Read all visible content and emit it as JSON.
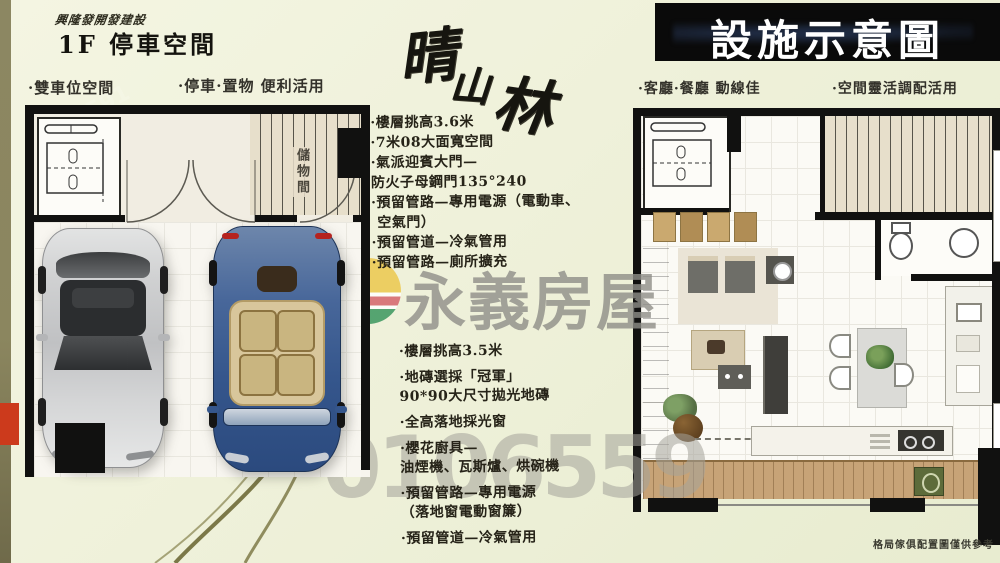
{
  "header_left": {
    "developer": "興隆發開發建設",
    "title": "1F 停車空間",
    "feature1": "·雙車位空間",
    "feature2": "·停車·置物 便利活用"
  },
  "banner": {
    "title": "設施示意圖"
  },
  "header_right": {
    "feature1": "·客廳·餐廳 動線佳",
    "feature2": "·空間靈活調配活用"
  },
  "brand_script": {
    "char1": "晴",
    "char2": "山",
    "char3": "林"
  },
  "garage_plan": {
    "storage_label": "儲物間"
  },
  "notes_garage": {
    "l1": "·樓層挑高3.6米",
    "l2": "·7米08大面寬空間",
    "l3": "·氣派迎賓大門—",
    "l4": "防火子母鋼門135°240",
    "l5": "·預留管路—專用電源（電動車、",
    "l6": "空氣門）",
    "l7": "·預留管道—冷氣管用",
    "l8": "·預留管路—廁所擴充"
  },
  "notes_living": {
    "l1": "·樓層挑高3.5米",
    "l2": "·地磚選採「冠軍」",
    "l3": "90*90大尺寸拋光地磚",
    "l4": "·全高落地採光窗",
    "l5": "·櫻花廚具—",
    "l6": "油煙機、瓦斯爐、烘碗機",
    "l7": "·預留管路—專用電源",
    "l8": "（落地窗電動窗簾）",
    "l9": "·預留管道—冷氣管用"
  },
  "watermark": {
    "brand": "永義房屋",
    "number": "0106559",
    "site": "591"
  },
  "footnote": "格局傢俱配置圖僅供參考",
  "palette": {
    "strip_olive": "#8c8762",
    "accent_red": "#cc3a1c",
    "wall_black": "#111110",
    "stairs_beige": "#e7dfcb",
    "wood_deck": "#c7a377",
    "brand_gray": "#8f8e88",
    "logo_yellow": "#ecc84d",
    "logo_red": "#d5646b",
    "logo_green": "#3a975e",
    "car_silver": "#c9cacc",
    "car_blue": "#3c5d92"
  }
}
